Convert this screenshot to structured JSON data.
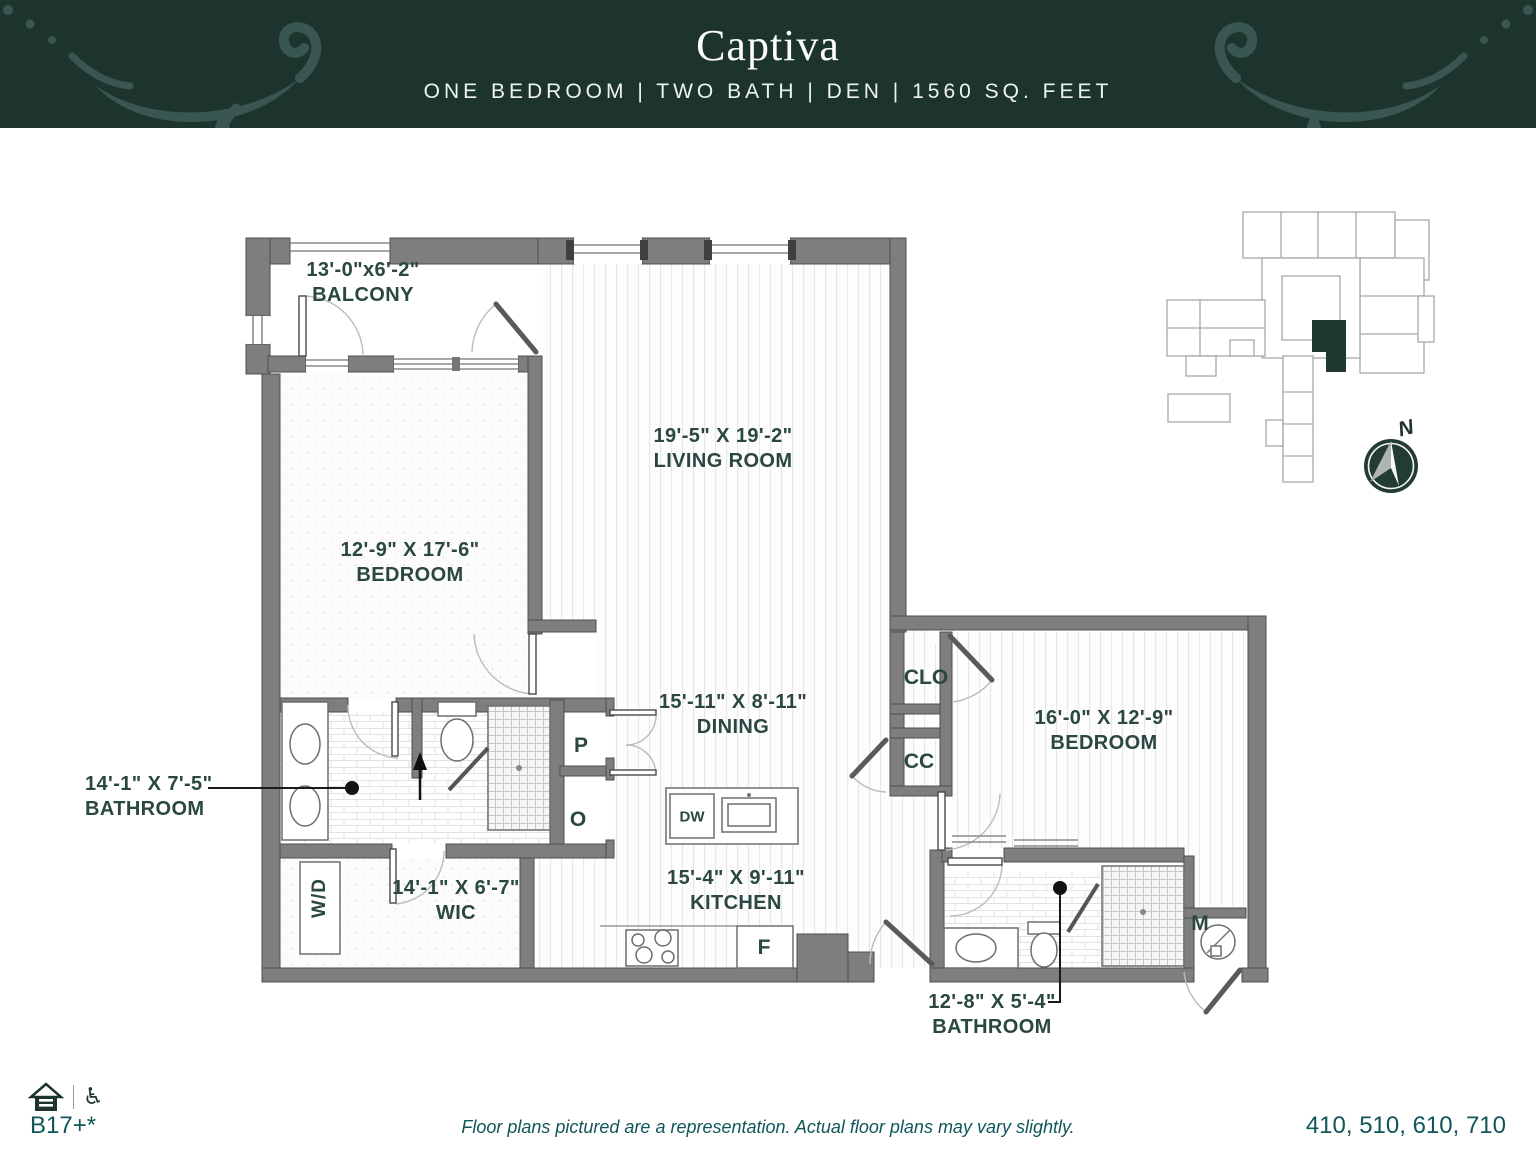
{
  "header": {
    "title": "Captiva",
    "subtitle": "ONE BEDROOM | TWO BATH | DEN | 1560 SQ. FEET"
  },
  "rooms": {
    "balcony": {
      "dims": "13'-0\"x6'-2\"",
      "name": "BALCONY"
    },
    "living_room": {
      "dims": "19'-5\" X 19'-2\"",
      "name": "LIVING ROOM"
    },
    "bedroom_left": {
      "dims": "12'-9\" X 17'-6\"",
      "name": "BEDROOM"
    },
    "bathroom_left": {
      "dims": "14'-1\" X 7'-5\"",
      "name": "BATHROOM"
    },
    "wic": {
      "dims": "14'-1\" X 6'-7\"",
      "name": "WIC"
    },
    "dining": {
      "dims": "15'-11\" X 8'-11\"",
      "name": "DINING"
    },
    "kitchen": {
      "dims": "15'-4\" X 9'-11\"",
      "name": "KITCHEN"
    },
    "bedroom_right": {
      "dims": "16'-0\" X 12'-9\"",
      "name": "BEDROOM"
    },
    "bathroom_right": {
      "dims": "12'-8\" X 5'-4\"",
      "name": "BATHROOM"
    }
  },
  "fixtures": {
    "washer_dryer": "W/D",
    "pantry": "P",
    "oven": "O",
    "dishwasher": "DW",
    "refrigerator": "F",
    "closet": "CLO",
    "coat_closet": "CC",
    "mechanical": "M"
  },
  "compass": {
    "north_label": "N"
  },
  "icons": {
    "accessible_symbol": "♿"
  },
  "footer": {
    "plan_code": "B17+*",
    "disclaimer": "Floor plans pictured are a representation. Actual floor plans may vary slightly.",
    "unit_numbers": "410, 510, 610, 710"
  },
  "colors": {
    "header_bg": "#1d342e",
    "ornament": "#3a5650",
    "label_text": "#2a4742",
    "footer_text": "#10565a",
    "wall_fill": "#7e7e7e",
    "site_unit_fill": "#1f3831"
  }
}
